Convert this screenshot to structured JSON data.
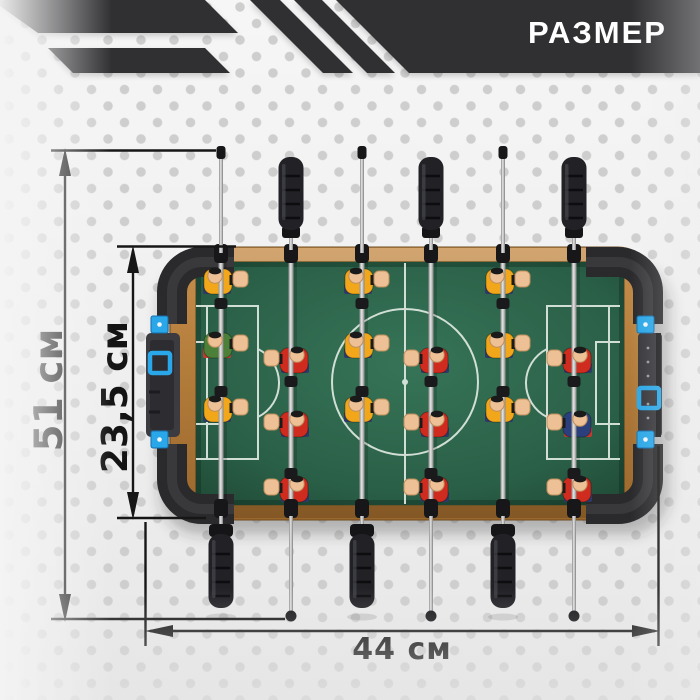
{
  "header": {
    "title": "РАЗМЕР"
  },
  "dimensions": {
    "overall_length_label": "51 см",
    "playfield_width_label": "23,5 см",
    "table_length_label": "44 см"
  },
  "colors": {
    "banner": "#302f32",
    "dimension_lines": "#161616",
    "field_green": "#2e6a50",
    "wood_frame": "#b5803e",
    "bumper_black": "#2a2a2d",
    "accent_blue": "#2aa7e8",
    "team_yellow": "#f2a71b",
    "team_red": "#d02b1f",
    "keeper_green": "#4c8038",
    "keeper_navy": "#2c3f7d",
    "skin": "#edc095",
    "shorts_navy": "#2c3a68",
    "shorts_red": "#c23b2e"
  }
}
